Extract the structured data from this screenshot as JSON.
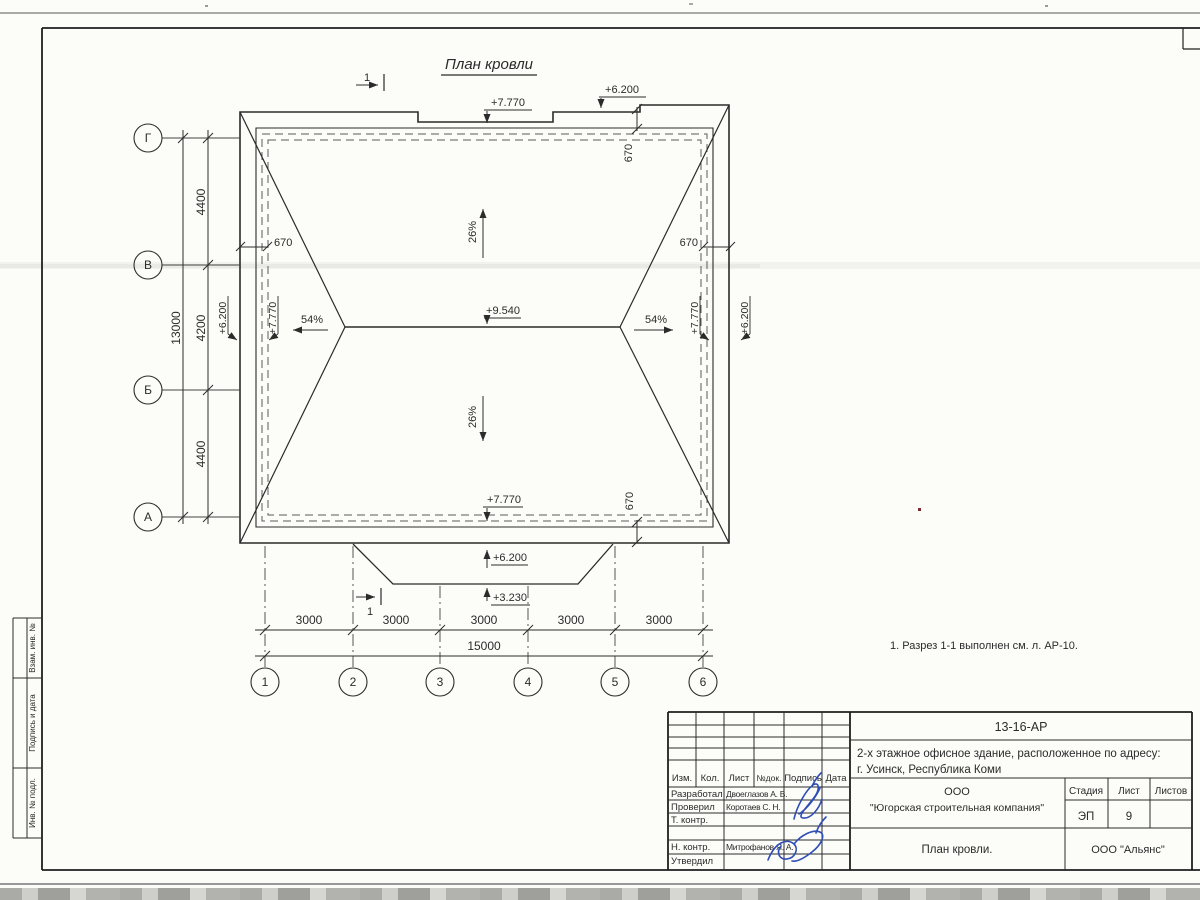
{
  "plan": {
    "title": "План кровли",
    "note": "1. Разрез 1-1 выполнен см. л. АР-10.",
    "section_mark": "1",
    "slope_26": "26%",
    "slope_54": "54%",
    "offset_670": "670",
    "elev_7770": "+7.770",
    "elev_6200": "+6.200",
    "elev_9540": "+9.540",
    "elev_3230": "+3.230"
  },
  "axes": {
    "letters": [
      "Г",
      "В",
      "Б",
      "А"
    ],
    "numbers": [
      "1",
      "2",
      "3",
      "4",
      "5",
      "6"
    ]
  },
  "dims": {
    "left_segments": [
      "4400",
      "4200",
      "4400"
    ],
    "left_total": "13000",
    "bottom_segments": [
      "3000",
      "3000",
      "3000",
      "3000",
      "3000"
    ],
    "bottom_total": "15000"
  },
  "margin": {
    "labels": [
      "Взам. инв. №",
      "Подпись и дата",
      "Инв. № подл."
    ]
  },
  "title_block": {
    "doc_code": "13-16-АР",
    "address_line1": "2-х этажное офисное здание, расположенное по адресу:",
    "address_line2": "г. Усинск, Республика Коми",
    "header_cols": [
      "Изм.",
      "Кол.",
      "Лист",
      "№док.",
      "Подпись",
      "Дата"
    ],
    "rows": [
      {
        "role": "Разработал",
        "name": "Двоеглазов А. В."
      },
      {
        "role": "Проверил",
        "name": "Коротаев С. Н."
      },
      {
        "role": "Т. контр.",
        "name": ""
      },
      {
        "role": "Н. контр.",
        "name": "Митрофанов Я. А."
      },
      {
        "role": "Утвердил",
        "name": ""
      }
    ],
    "company_line1": "ООО",
    "company_line2": "\"Югорская строительная компания\"",
    "stage_label": "Стадия",
    "sheet_label": "Лист",
    "sheets_label": "Листов",
    "stage_value": "ЭП",
    "sheet_value": "9",
    "drawing_title": "План кровли.",
    "firm": "ООО \"Альянс\""
  },
  "colors": {
    "line": "#2b2b2b",
    "signature": "#2f4eb5",
    "paper": "#fcfcf9"
  }
}
